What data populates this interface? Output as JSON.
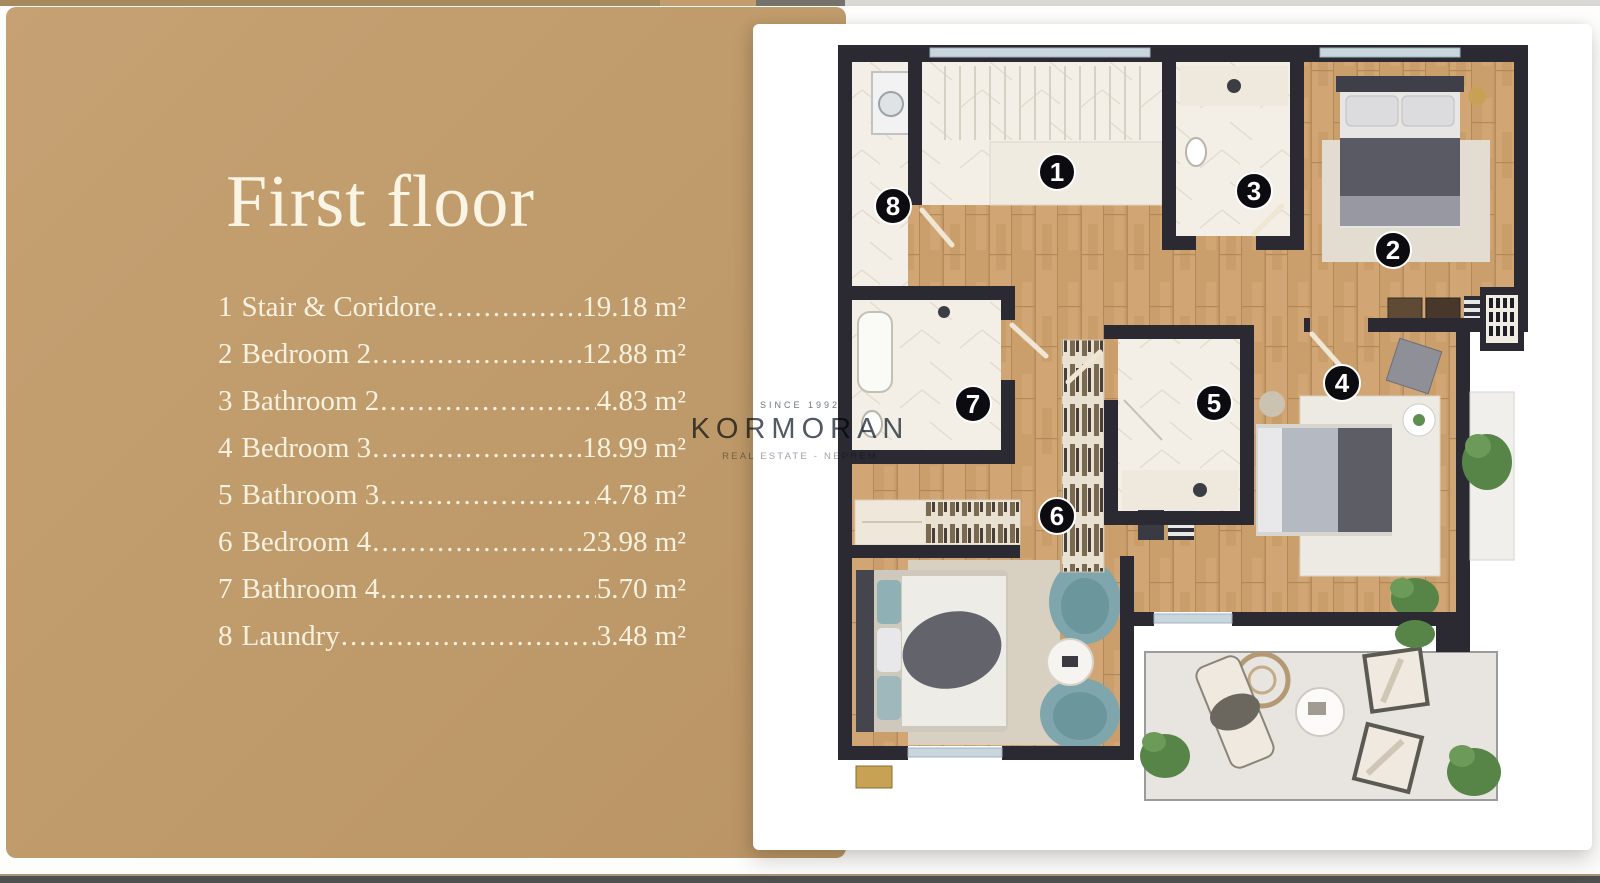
{
  "panel": {
    "title": "First floor"
  },
  "legend": {
    "items": [
      {
        "num": "1",
        "label": "Stair & Coridore",
        "dots": "................................................",
        "area": "19.18 m²"
      },
      {
        "num": "2",
        "label": "Bedroom 2",
        "dots": "................................................",
        "area": "12.88 m²"
      },
      {
        "num": "3",
        "label": "Bathroom 2",
        "dots": "................................................",
        "area": "4.83 m²"
      },
      {
        "num": "4",
        "label": "Bedroom 3",
        "dots": "................................................",
        "area": "18.99 m²"
      },
      {
        "num": "5",
        "label": "Bathroom 3",
        "dots": "................................................",
        "area": "4.78 m²"
      },
      {
        "num": "6",
        "label": "Bedroom 4",
        "dots": "................................................",
        "area": "23.98 m²"
      },
      {
        "num": "7",
        "label": "Bathroom 4",
        "dots": "................................................",
        "area": "5.70 m²"
      },
      {
        "num": "8",
        "label": "Laundry",
        "dots": "................................................",
        "area": "3.48 m²"
      }
    ]
  },
  "watermark": {
    "since": "SINCE 1992",
    "brand": "KORMORAN",
    "tagline": "REAL ESTATE - NEPREM"
  },
  "floorplan": {
    "badges": [
      {
        "n": "1",
        "x": 1057,
        "y": 172
      },
      {
        "n": "2",
        "x": 1393,
        "y": 250
      },
      {
        "n": "3",
        "x": 1254,
        "y": 191
      },
      {
        "n": "4",
        "x": 1342,
        "y": 383
      },
      {
        "n": "5",
        "x": 1214,
        "y": 403
      },
      {
        "n": "6",
        "x": 1057,
        "y": 516
      },
      {
        "n": "7",
        "x": 973,
        "y": 404
      },
      {
        "n": "8",
        "x": 893,
        "y": 206
      }
    ]
  },
  "colors": {
    "panel_tan": "#c09d6e",
    "wall": "#2b2a33",
    "wood_floor": "#d1a674",
    "marble_floor": "#f3efe7",
    "terrace_floor": "#e8e4e0",
    "accent_teal": "#7fa7ad",
    "legend_text": "#f7f1df",
    "badge": "#0c0c10"
  }
}
